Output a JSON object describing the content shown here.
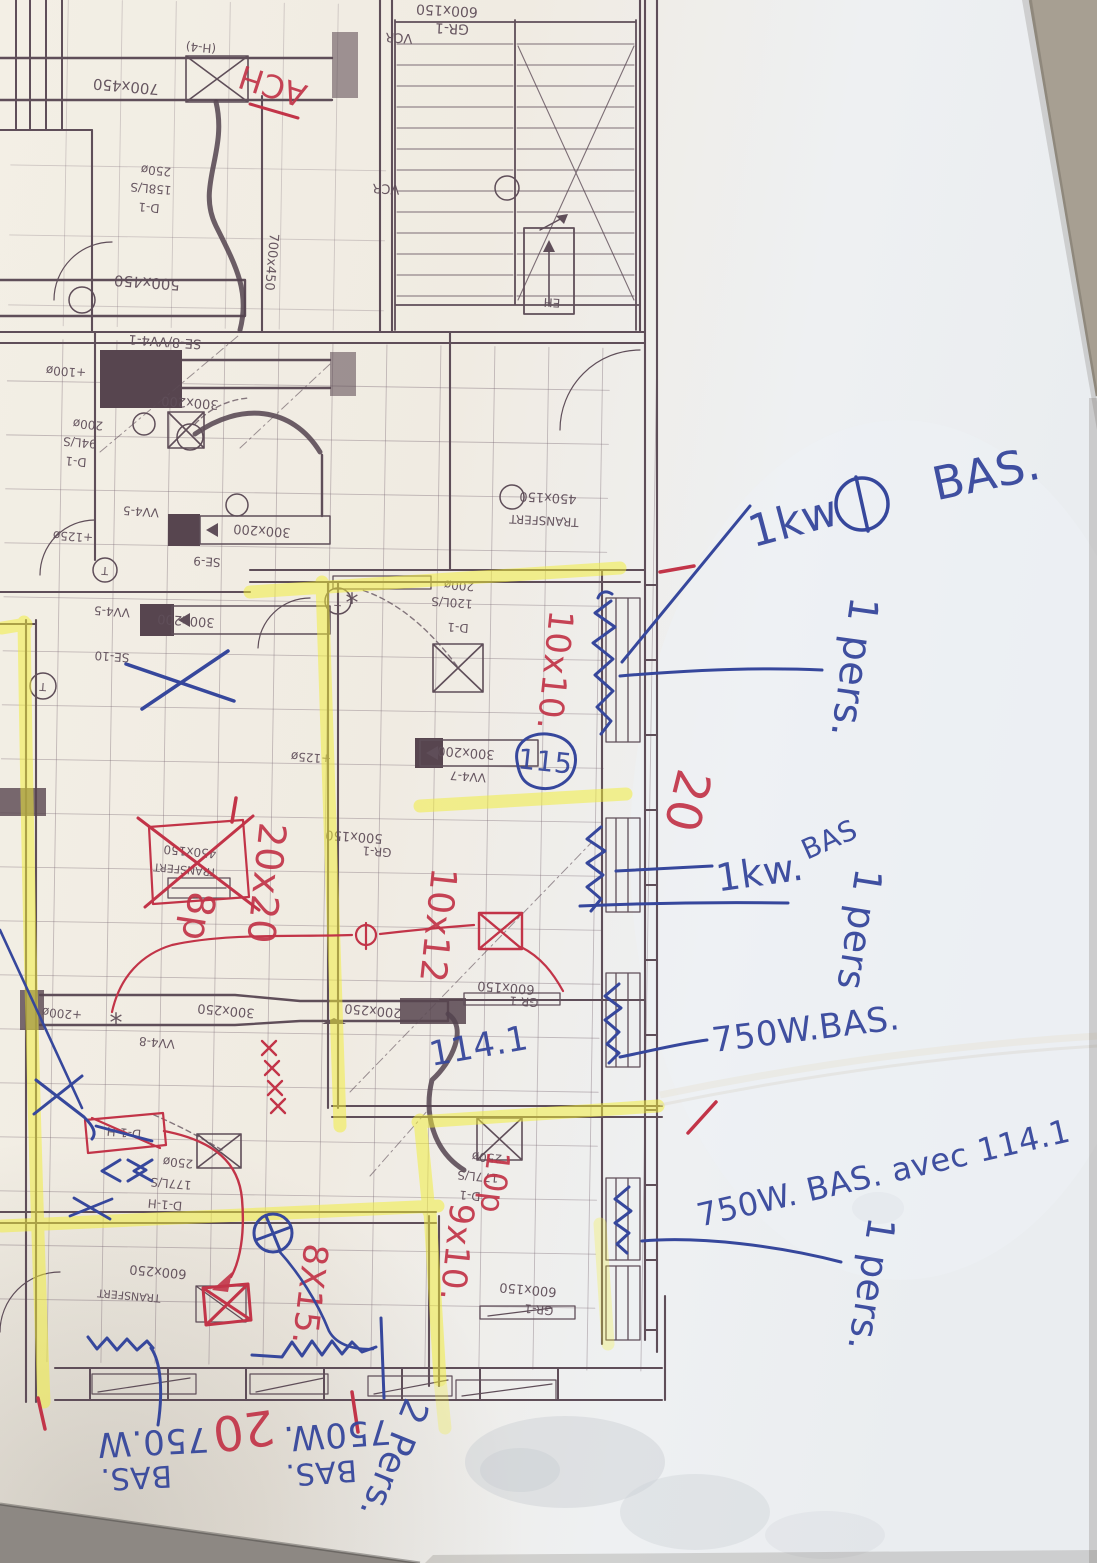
{
  "scene": {
    "description": "Photograph of a printed HVAC floor plan (print rotated 180°) with yellow highlighter zones and handwritten red and blue pen annotations for baseboard heaters",
    "paper_color": "#f2eee5",
    "desk_color": "#a79f92",
    "print_color": "#5f4e59",
    "highlighter_color": "#f2ee38",
    "red_pen_color": "#c23448",
    "blue_pen_color": "#36479c"
  },
  "plan": {
    "printed_labels": [
      {
        "t": "600x150",
        "x": 447,
        "y": 10,
        "r": 183,
        "s": 14
      },
      {
        "t": "GR-1",
        "x": 452,
        "y": 28,
        "r": 183,
        "s": 14
      },
      {
        "t": "VCR",
        "x": 399,
        "y": 37,
        "r": 183,
        "s": 13
      },
      {
        "t": "(H-4)",
        "x": 201,
        "y": 47,
        "r": 185,
        "s": 12
      },
      {
        "t": "700x450",
        "x": 126,
        "y": 86,
        "r": 185,
        "s": 15
      },
      {
        "t": "VCR",
        "x": 386,
        "y": 188,
        "r": 183,
        "s": 13
      },
      {
        "t": "250ø",
        "x": 156,
        "y": 170,
        "r": 185,
        "s": 12
      },
      {
        "t": "158L/S",
        "x": 151,
        "y": 188,
        "r": 185,
        "s": 12
      },
      {
        "t": "D-1",
        "x": 149,
        "y": 207,
        "r": 185,
        "s": 12
      },
      {
        "t": "500x450",
        "x": 147,
        "y": 282,
        "r": 184,
        "s": 15
      },
      {
        "t": "700x450",
        "x": 271,
        "y": 262,
        "r": 95,
        "s": 13
      },
      {
        "t": "EH",
        "x": 552,
        "y": 302,
        "r": 183,
        "s": 12
      },
      {
        "t": "SE-8/VV4-1",
        "x": 165,
        "y": 341,
        "r": 184,
        "s": 13
      },
      {
        "t": "+100ø",
        "x": 66,
        "y": 371,
        "r": 184,
        "s": 12
      },
      {
        "t": "300x200",
        "x": 190,
        "y": 402,
        "r": 184,
        "s": 13
      },
      {
        "t": "200ø",
        "x": 88,
        "y": 424,
        "r": 185,
        "s": 12
      },
      {
        "t": "94L/S",
        "x": 80,
        "y": 442,
        "r": 185,
        "s": 12
      },
      {
        "t": "D-1",
        "x": 76,
        "y": 461,
        "r": 185,
        "s": 12
      },
      {
        "t": "450x150",
        "x": 548,
        "y": 497,
        "r": 183,
        "s": 13
      },
      {
        "t": "TRANSFERT",
        "x": 544,
        "y": 520,
        "r": 183,
        "s": 12
      },
      {
        "t": "VV4-5",
        "x": 141,
        "y": 511,
        "r": 184,
        "s": 12
      },
      {
        "t": "300x200",
        "x": 262,
        "y": 530,
        "r": 184,
        "s": 13
      },
      {
        "t": "+125ø",
        "x": 73,
        "y": 536,
        "r": 184,
        "s": 12
      },
      {
        "t": "SE-9",
        "x": 207,
        "y": 561,
        "r": 184,
        "s": 12
      },
      {
        "t": "T",
        "x": 105,
        "y": 570,
        "r": 184,
        "s": 11
      },
      {
        "t": "VV4-5",
        "x": 112,
        "y": 611,
        "r": 184,
        "s": 12
      },
      {
        "t": "300x200",
        "x": 186,
        "y": 620,
        "r": 184,
        "s": 13
      },
      {
        "t": "SE-10",
        "x": 112,
        "y": 656,
        "r": 184,
        "s": 12
      },
      {
        "t": "T",
        "x": 43,
        "y": 686,
        "r": 184,
        "s": 11
      },
      {
        "t": "T",
        "x": 338,
        "y": 601,
        "r": 184,
        "s": 11
      },
      {
        "t": "200ø",
        "x": 459,
        "y": 585,
        "r": 184,
        "s": 12
      },
      {
        "t": "120L/S",
        "x": 452,
        "y": 602,
        "r": 184,
        "s": 12
      },
      {
        "t": "D-1",
        "x": 458,
        "y": 627,
        "r": 184,
        "s": 12
      },
      {
        "t": "300x200",
        "x": 466,
        "y": 752,
        "r": 184,
        "s": 13
      },
      {
        "t": "VV4-7",
        "x": 468,
        "y": 776,
        "r": 184,
        "s": 12
      },
      {
        "t": "+125ø",
        "x": 311,
        "y": 757,
        "r": 184,
        "s": 12
      },
      {
        "t": "450x150",
        "x": 190,
        "y": 851,
        "r": 185,
        "s": 12
      },
      {
        "t": "TRANSFERT",
        "x": 185,
        "y": 869,
        "r": 185,
        "s": 11
      },
      {
        "t": "500x150",
        "x": 354,
        "y": 836,
        "r": 184,
        "s": 13
      },
      {
        "t": "GR-1",
        "x": 377,
        "y": 851,
        "r": 184,
        "s": 12
      },
      {
        "t": "300x250",
        "x": 226,
        "y": 1010,
        "r": 185,
        "s": 13
      },
      {
        "t": "200x250",
        "x": 373,
        "y": 1010,
        "r": 185,
        "s": 13
      },
      {
        "t": "600x150",
        "x": 506,
        "y": 987,
        "r": 184,
        "s": 13
      },
      {
        "t": "GR-1",
        "x": 524,
        "y": 1001,
        "r": 184,
        "s": 12
      },
      {
        "t": "VV4-8",
        "x": 157,
        "y": 1042,
        "r": 185,
        "s": 12
      },
      {
        "t": "+200ø",
        "x": 62,
        "y": 1013,
        "r": 185,
        "s": 12
      },
      {
        "t": "D-1-H",
        "x": 124,
        "y": 1132,
        "r": 185,
        "s": 12
      },
      {
        "t": "250ø",
        "x": 178,
        "y": 1162,
        "r": 185,
        "s": 12
      },
      {
        "t": "177L/S",
        "x": 171,
        "y": 1183,
        "r": 185,
        "s": 12
      },
      {
        "t": "D-1-H",
        "x": 165,
        "y": 1204,
        "r": 185,
        "s": 12
      },
      {
        "t": "250ø",
        "x": 487,
        "y": 1157,
        "r": 185,
        "s": 12
      },
      {
        "t": "177L/S",
        "x": 478,
        "y": 1176,
        "r": 185,
        "s": 12
      },
      {
        "t": "D-1",
        "x": 470,
        "y": 1195,
        "r": 185,
        "s": 12
      },
      {
        "t": "600x250",
        "x": 158,
        "y": 1271,
        "r": 185,
        "s": 13
      },
      {
        "t": "TRANSFERT",
        "x": 129,
        "y": 1295,
        "r": 185,
        "s": 11
      },
      {
        "t": "600x150",
        "x": 528,
        "y": 1289,
        "r": 185,
        "s": 13
      },
      {
        "t": "GR-1",
        "x": 539,
        "y": 1309,
        "r": 185,
        "s": 12
      },
      {
        "t": "*",
        "x": 352,
        "y": 604,
        "r": 0,
        "s": 26
      },
      {
        "t": "*",
        "x": 116,
        "y": 1024,
        "r": 0,
        "s": 26
      }
    ]
  },
  "annotations": {
    "red": [
      {
        "t": "ACH",
        "x": 273,
        "y": 84,
        "r": 198,
        "s": 32
      },
      {
        "t": "10x10.",
        "x": 553,
        "y": 670,
        "r": 96,
        "s": 34
      },
      {
        "t": "20",
        "x": 684,
        "y": 800,
        "r": 104,
        "s": 48
      },
      {
        "t": "20x20",
        "x": 264,
        "y": 883,
        "r": 96,
        "s": 38
      },
      {
        "t": "8p",
        "x": 196,
        "y": 916,
        "r": 99,
        "s": 38
      },
      {
        "t": "10x12",
        "x": 436,
        "y": 925,
        "r": 96,
        "s": 36
      },
      {
        "t": "10p",
        "x": 493,
        "y": 1182,
        "r": 97,
        "s": 32
      },
      {
        "t": "9x10.",
        "x": 455,
        "y": 1252,
        "r": 96,
        "s": 34
      },
      {
        "t": "8X15.",
        "x": 308,
        "y": 1294,
        "r": 97,
        "s": 34
      },
      {
        "t": "20",
        "x": 243,
        "y": 1427,
        "r": 172,
        "s": 48
      }
    ],
    "blue": [
      {
        "t": "1kw",
        "x": 794,
        "y": 524,
        "r": -15,
        "s": 44
      },
      {
        "t": "BAS.",
        "x": 987,
        "y": 477,
        "r": -12,
        "s": 46
      },
      {
        "t": "1 pers.",
        "x": 852,
        "y": 667,
        "r": 98,
        "s": 40
      },
      {
        "t": "1kw.",
        "x": 760,
        "y": 875,
        "r": -8,
        "s": 38
      },
      {
        "t": "BAS",
        "x": 830,
        "y": 841,
        "r": -24,
        "s": 28
      },
      {
        "t": "1 pers",
        "x": 857,
        "y": 929,
        "r": 99,
        "s": 38
      },
      {
        "t": "750W.BAS.",
        "x": 806,
        "y": 1031,
        "r": -7,
        "s": 34
      },
      {
        "t": "750W. BAS. avec 114.1",
        "x": 884,
        "y": 1175,
        "r": -13,
        "s": 32
      },
      {
        "t": "1 pers.",
        "x": 869,
        "y": 1284,
        "r": 99,
        "s": 38
      },
      {
        "t": "114.1",
        "x": 479,
        "y": 1048,
        "r": -10,
        "s": 34
      },
      {
        "t": "115",
        "x": 545,
        "y": 763,
        "r": 6,
        "s": 28
      },
      {
        "t": "750W.",
        "x": 337,
        "y": 1433,
        "r": 176,
        "s": 34
      },
      {
        "t": "BAS.",
        "x": 321,
        "y": 1471,
        "r": 176,
        "s": 30
      },
      {
        "t": "2 Pers.",
        "x": 392,
        "y": 1458,
        "r": 112,
        "s": 36
      },
      {
        "t": "750.W",
        "x": 153,
        "y": 1440,
        "r": 177,
        "s": 34
      },
      {
        "t": "BAS.",
        "x": 136,
        "y": 1476,
        "r": 177,
        "s": 30
      }
    ]
  }
}
